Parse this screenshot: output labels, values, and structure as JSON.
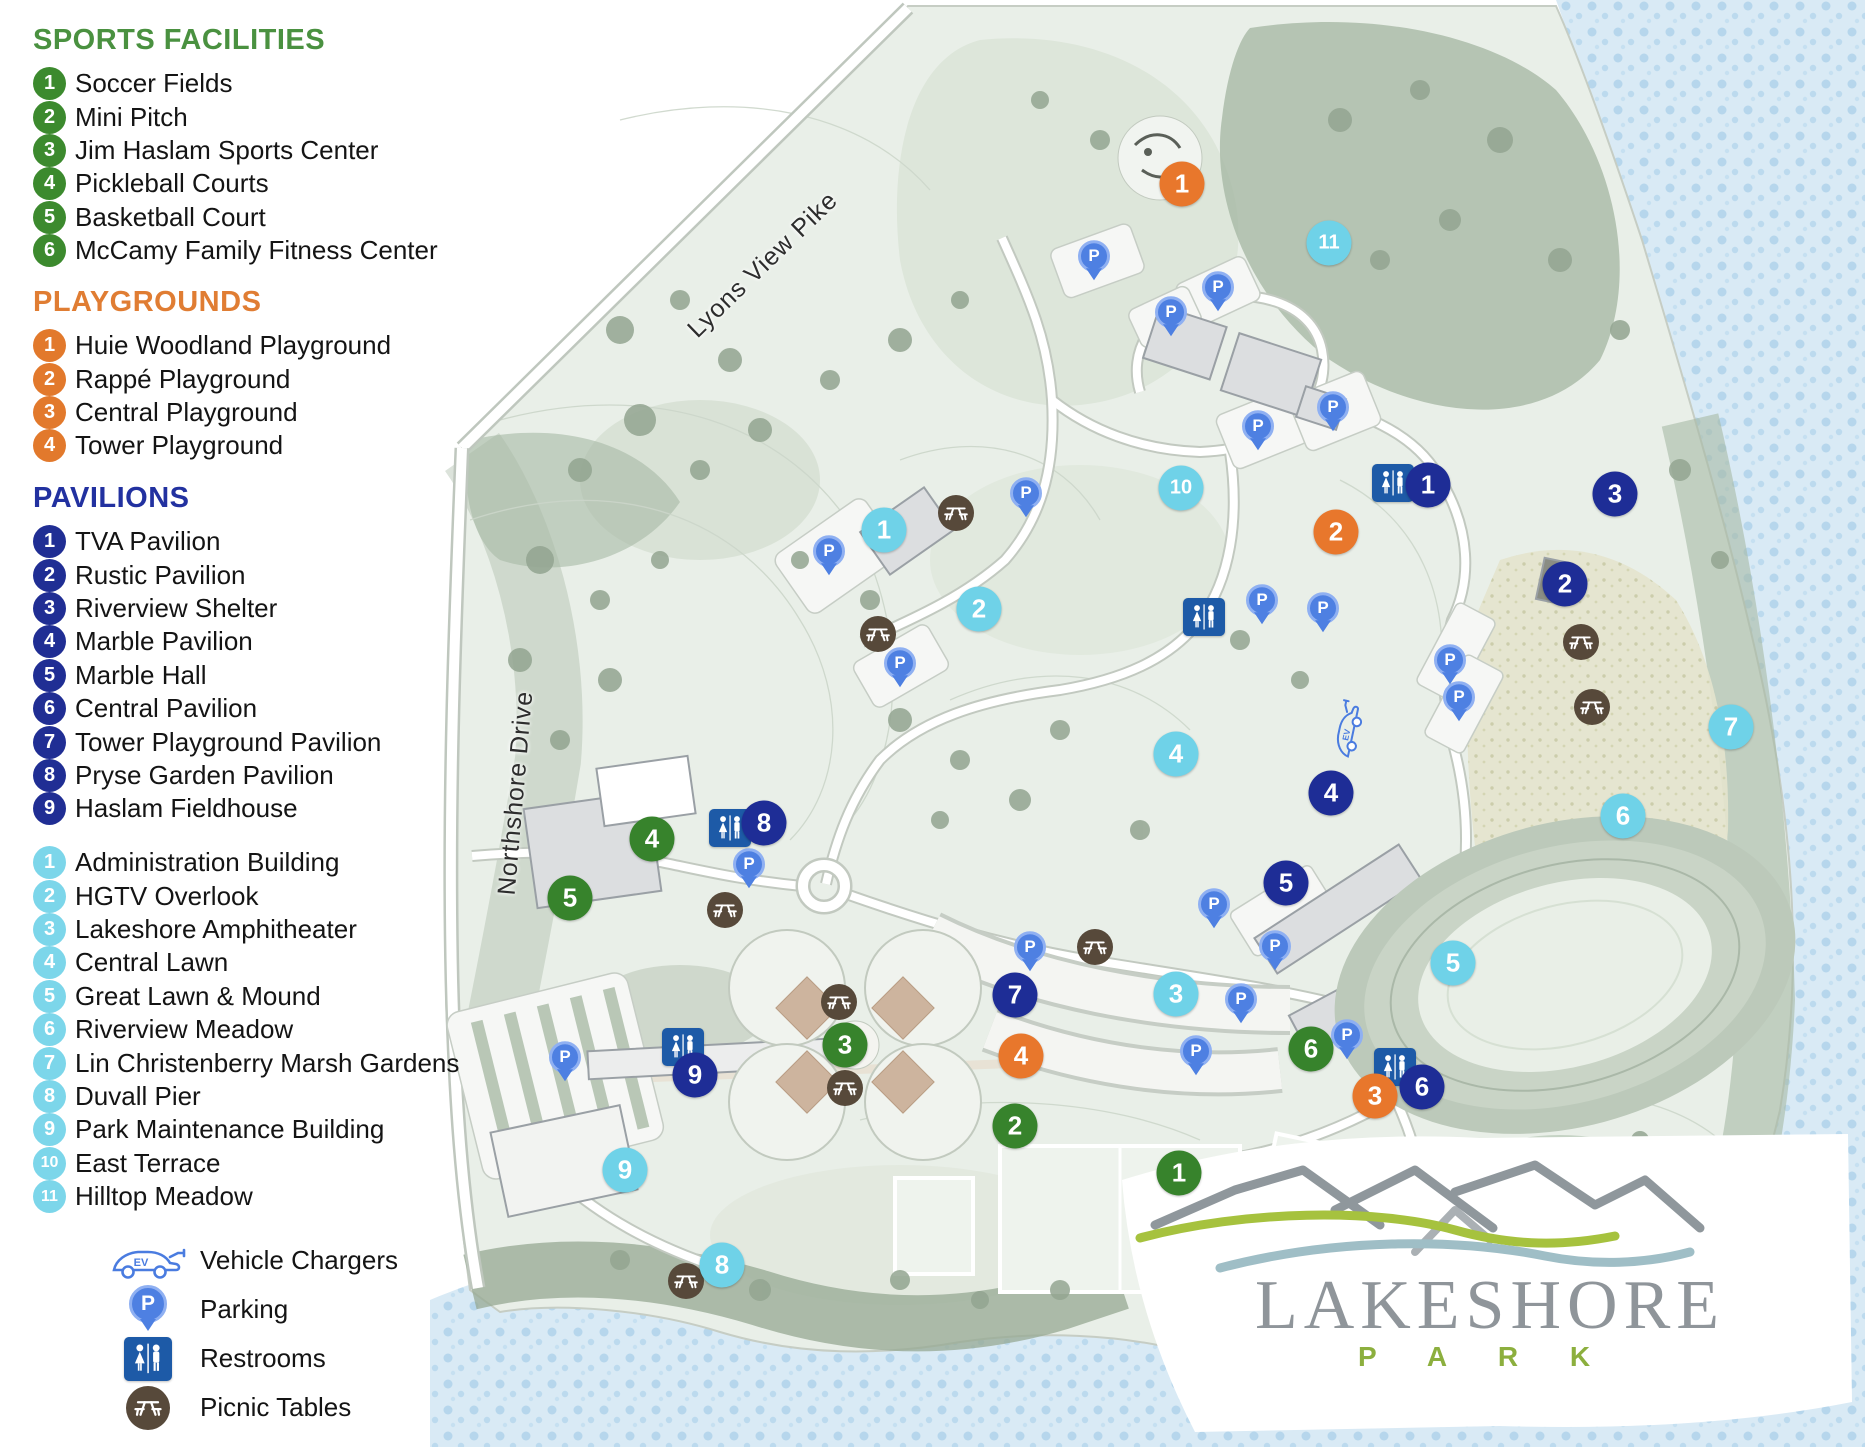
{
  "legend": {
    "sections": [
      {
        "id": "sports",
        "title": "SPORTS FACILITIES",
        "title_color": "#4a9140",
        "marker_color": "#3c8a2e",
        "items": [
          "Soccer Fields",
          "Mini Pitch",
          "Jim Haslam Sports Center",
          "Pickleball Courts",
          "Basketball Court",
          "McCamy Family Fitness Center"
        ]
      },
      {
        "id": "playgrounds",
        "title": "PLAYGROUNDS",
        "title_color": "#e07d33",
        "marker_color": "#e2792c",
        "items": [
          "Huie Woodland Playground",
          "Rappé Playground",
          "Central Playground",
          "Tower Playground"
        ]
      },
      {
        "id": "pavilions",
        "title": "PAVILIONS",
        "title_color": "#2231a0",
        "marker_color": "#202e94",
        "items": [
          "TVA Pavilion",
          "Rustic Pavilion",
          "Riverview Shelter",
          "Marble Pavilion",
          "Marble Hall",
          "Central Pavilion",
          "Tower Playground Pavilion",
          "Pryse Garden Pavilion",
          "Haslam Fieldhouse"
        ]
      },
      {
        "id": "features",
        "title": "",
        "title_color": "#7cd6ea",
        "marker_color": "#7cd6ea",
        "items": [
          "Administration Building",
          "HGTV Overlook",
          "Lakeshore Amphitheater",
          "Central Lawn",
          "Great Lawn & Mound",
          "Riverview Meadow",
          "Lin Christenberry Marsh Gardens",
          "Duvall Pier",
          "Park Maintenance Building",
          "East Terrace",
          "Hilltop Meadow"
        ]
      }
    ],
    "symbols": [
      {
        "id": "ev",
        "label": "Vehicle Chargers"
      },
      {
        "id": "parking",
        "label": "Parking"
      },
      {
        "id": "restrooms",
        "label": "Restrooms"
      },
      {
        "id": "picnic",
        "label": "Picnic Tables"
      }
    ]
  },
  "colors": {
    "sports": "#37832c",
    "playgrounds": "#e8772c",
    "pavilions": "#1e2d96",
    "features": "#6fd2e8",
    "parking": "#4e80e2",
    "restroom": "#1d5aa7",
    "picnic": "#57493a",
    "ev_stroke": "#4a7ce0",
    "water": "#d9eaf5",
    "logo_gray": "#8f959a",
    "logo_green": "#8caf3e"
  },
  "map": {
    "road_labels": [
      {
        "text": "Lyons View Pike",
        "x": 763,
        "y": 265,
        "angle": -44
      },
      {
        "text": "Northshore Drive",
        "x": 516,
        "y": 793,
        "angle": -85
      }
    ],
    "markers": [
      {
        "type": "sports",
        "items": [
          {
            "n": "1",
            "x": 1179,
            "y": 1173
          },
          {
            "n": "2",
            "x": 1015,
            "y": 1126
          },
          {
            "n": "3",
            "x": 845,
            "y": 1045
          },
          {
            "n": "4",
            "x": 652,
            "y": 839
          },
          {
            "n": "5",
            "x": 570,
            "y": 898
          },
          {
            "n": "6",
            "x": 1311,
            "y": 1049
          }
        ]
      },
      {
        "type": "playgrounds",
        "items": [
          {
            "n": "1",
            "x": 1182,
            "y": 184
          },
          {
            "n": "2",
            "x": 1336,
            "y": 532
          },
          {
            "n": "3",
            "x": 1375,
            "y": 1096
          },
          {
            "n": "4",
            "x": 1021,
            "y": 1056
          }
        ]
      },
      {
        "type": "pavilions",
        "items": [
          {
            "n": "1",
            "x": 1428,
            "y": 485
          },
          {
            "n": "2",
            "x": 1565,
            "y": 584
          },
          {
            "n": "3",
            "x": 1615,
            "y": 494
          },
          {
            "n": "4",
            "x": 1331,
            "y": 793
          },
          {
            "n": "5",
            "x": 1286,
            "y": 883
          },
          {
            "n": "6",
            "x": 1422,
            "y": 1087
          },
          {
            "n": "7",
            "x": 1015,
            "y": 995
          },
          {
            "n": "8",
            "x": 764,
            "y": 823
          },
          {
            "n": "9",
            "x": 695,
            "y": 1075
          }
        ]
      },
      {
        "type": "features",
        "items": [
          {
            "n": "1",
            "x": 884,
            "y": 530
          },
          {
            "n": "2",
            "x": 979,
            "y": 609
          },
          {
            "n": "3",
            "x": 1176,
            "y": 994
          },
          {
            "n": "4",
            "x": 1176,
            "y": 754
          },
          {
            "n": "5",
            "x": 1453,
            "y": 963
          },
          {
            "n": "6",
            "x": 1623,
            "y": 816
          },
          {
            "n": "7",
            "x": 1731,
            "y": 727
          },
          {
            "n": "8",
            "x": 722,
            "y": 1265
          },
          {
            "n": "9",
            "x": 625,
            "y": 1170
          },
          {
            "n": "10",
            "x": 1181,
            "y": 488
          },
          {
            "n": "11",
            "x": 1329,
            "y": 243
          }
        ]
      }
    ],
    "amenities": {
      "parking": [
        [
          1094,
          262
        ],
        [
          1218,
          293
        ],
        [
          1171,
          318
        ],
        [
          1258,
          432
        ],
        [
          1333,
          413
        ],
        [
          1026,
          499
        ],
        [
          829,
          557
        ],
        [
          900,
          669
        ],
        [
          1262,
          606
        ],
        [
          1323,
          614
        ],
        [
          1450,
          666
        ],
        [
          1459,
          703
        ],
        [
          749,
          870
        ],
        [
          565,
          1063
        ],
        [
          1030,
          953
        ],
        [
          1214,
          910
        ],
        [
          1241,
          1005
        ],
        [
          1196,
          1057
        ],
        [
          1275,
          952
        ],
        [
          1347,
          1041
        ]
      ],
      "restrooms": [
        [
          1393,
          483
        ],
        [
          1204,
          617
        ],
        [
          730,
          828
        ],
        [
          683,
          1047
        ],
        [
          1395,
          1067
        ]
      ],
      "picnic": [
        [
          956,
          513
        ],
        [
          878,
          634
        ],
        [
          725,
          910
        ],
        [
          1095,
          947
        ],
        [
          839,
          1002
        ],
        [
          845,
          1088
        ],
        [
          1581,
          642
        ],
        [
          1592,
          707
        ],
        [
          686,
          1281
        ]
      ],
      "ev": [
        [
          1350,
          730
        ]
      ]
    },
    "logo": {
      "name": "LAKESHORE",
      "sub": "P A R K"
    }
  }
}
